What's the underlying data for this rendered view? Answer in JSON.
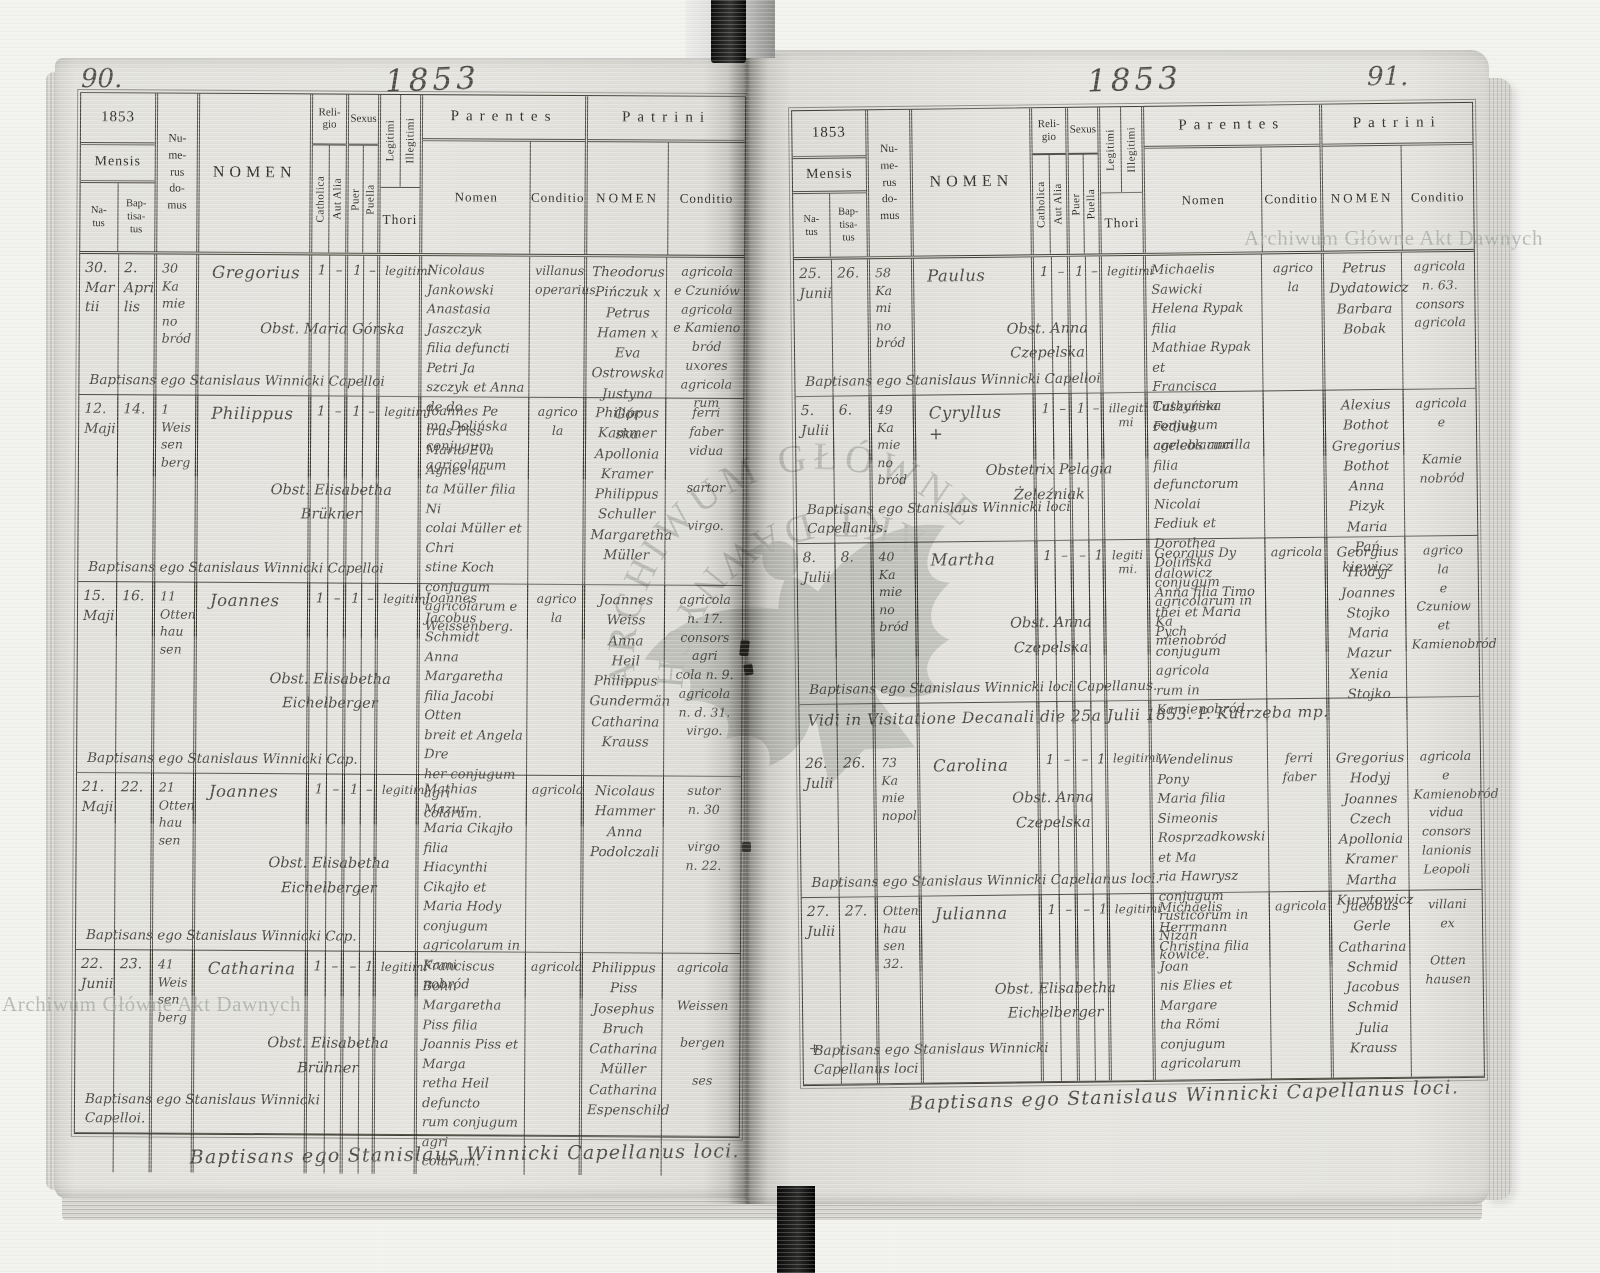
{
  "document": {
    "archive_stamp": "Archiwum Główne Akt Dawnych",
    "stamp_arc_top": "ARCHIWUM GŁÓWNE",
    "stamp_arc_bottom": "AKT DAWNYCH"
  },
  "columns": {
    "year": "1853",
    "mensis": "Mensis",
    "natus": "Na-\ntus",
    "baptisatus": "Bap-\ntisa-\ntus",
    "numerus_domus": "Nu-\nme-\nrus\ndo-\nmus",
    "nomen": "NOMEN",
    "religio": "Reli-\ngio",
    "catholica": "Catholica",
    "aut_alia": "Aut Alia",
    "sexus": "Sexus",
    "puer": "Puer",
    "puella": "Puella",
    "legitimi": "Legitimi",
    "illegitimi": "Illegitimi",
    "thori": "Thori",
    "parentes": "Parentes",
    "patrini": "Patrini",
    "sub_nomen": "Nomen",
    "sub_conditio": "Conditio",
    "patrini_nomen": "NOMEN",
    "patrini_conditio": "Conditio"
  },
  "left_page": {
    "page_number": "90.",
    "year_script": "1853",
    "footer_script": "Baptisans ego Stanislaus Winnicki Capellanus loci.",
    "rows": [
      {
        "natus": "30.\nMar\ntii",
        "baptisatus": "2.\nApri\nlis",
        "domus": "30\nKa\nmie\nno\nbród",
        "nomen": "Gregorius",
        "obstetrix": "Obst. Maria Górska",
        "baptisans": "Baptisans ego Stanislaus Winnicki Capelloi",
        "catholica": "1",
        "aut_alia": "–",
        "puer": "1",
        "puella": "–",
        "thori": "legitimi",
        "parentes_nomen": "Nicolaus\nJankowski\nAnastasia Jaszczyk\nfilia defuncti Petri Ja\nszczyk et Anna de do\nmo Dolińska conjugum\nagricolarum",
        "parentes_conditio": "villanus\noperarius",
        "patrini_nomen": "Theodorus\nPińczuk x\nPetrus\nHamen x\nEva Ostrowska\nJustyna Gór\nska",
        "patrini_conditio": "agricola\ne Czuniów\nagricola\ne Kamieno\nbród\nuxores\nagricola\nrum"
      },
      {
        "natus": "12.\nMaji",
        "baptisatus": "14.",
        "domus": "1\nWeis\nsen\nberg",
        "nomen": "Philippus",
        "obstetrix": "Obst. Elisabetha\nBrükner",
        "baptisans": "Baptisans ego Stanislaus Winnicki Capelloi",
        "catholica": "1",
        "aut_alia": "–",
        "puer": "1",
        "puella": "–",
        "thori": "legitimi",
        "parentes_nomen": "Joannes Pe\ntrus Piss\nMaria Eva Agnes na\nta Müller filia Ni\ncolai Müller et Chri\nstine Koch conjugum\nagricolarum e\nWeissenberg.",
        "parentes_conditio": "agrico\nla",
        "patrini_nomen": "Philippus\nKammer\nApollonia\nKramer\nPhilippus\nSchuller\nMargaretha\nMüller",
        "patrini_conditio": "ferri\nfaber\nvidua\n\nsartor\n\nvirgo."
      },
      {
        "natus": "15.\nMaji",
        "baptisatus": "16.",
        "domus": "11\nOtten\nhau\nsen",
        "nomen": "Joannes",
        "obstetrix": "Obst. Elisabetha\nEichelberger",
        "baptisans": "Baptisans ego Stanislaus Winnicki Cap.",
        "catholica": "1",
        "aut_alia": "–",
        "puer": "1",
        "puella": "–",
        "thori": "legitimi",
        "parentes_nomen": "Joannes\nJacobus\nSchmidt\nAnna Margaretha\nfilia Jacobi Otten\nbreit et Angela Dre\nher conjugum agri\ncolarum.",
        "parentes_conditio": "agrico\nla",
        "patrini_nomen": "Joannes\nWeiss\nAnna\nHeil\nPhilippus\nGundermän\nCatharina\nKrauss",
        "patrini_conditio": "agricola\nn. 17.\nconsors agri\ncola n. 9.\nagricola\nn. d. 31.\nvirgo."
      },
      {
        "natus": "21.\nMaji",
        "baptisatus": "22.",
        "domus": "21\nOtten\nhau\nsen",
        "nomen": "Joannes",
        "obstetrix": "Obst. Elisabetha\nEichelberger",
        "baptisans": "Baptisans ego Stanislaus Winnicki Cap.",
        "catholica": "1",
        "aut_alia": "–",
        "puer": "1",
        "puella": "–",
        "thori": "legitimi",
        "parentes_nomen": "Mathias\nMazur\nMaria Cikajło filia\nHiacynthi Cikajło et\nMaria Hody conjugum\nagricolarum in Kami\nnobród",
        "parentes_conditio": "agricola",
        "patrini_nomen": "Nicolaus\nHammer\nAnna\nPodolczali",
        "patrini_conditio": "sutor\nn. 30\n\nvirgo\nn. 22."
      },
      {
        "natus": "22.\nJunii",
        "baptisatus": "23.",
        "domus": "41\nWeis\nsen\nberg",
        "nomen": "Catharina",
        "obstetrix": "Obst. Elisabetha\nBrühner",
        "baptisans": "Baptisans ego Stanislaus Winnicki\nCapelloi.",
        "catholica": "1",
        "aut_alia": "–",
        "puer": "–",
        "puella": "1",
        "thori": "legitimi",
        "parentes_nomen": "Franciscus\nBohn\nMargaretha Piss filia\nJoannis Piss et Marga\nretha Heil defuncto\nrum conjugum agri\ncolarum.",
        "parentes_conditio": "agricola",
        "patrini_nomen": "Philippus\nPiss\nJosephus\nBruch\nCatharina\nMüller\nCatharina\nEspenschild",
        "patrini_conditio": "agricola\n\nWeissen\n\nbergen\n\nses"
      }
    ]
  },
  "right_page": {
    "page_number": "91.",
    "year_script": "1853",
    "footer_script": "Baptisans ego Stanislaus Winnicki Capellanus loci.",
    "rows": [
      {
        "natus": "25.\nJunii",
        "baptisatus": "26.",
        "domus": "58\nKa\nmi\nno\nbród",
        "nomen": "Paulus",
        "obstetrix": "Obst. Anna\nCzepelska",
        "baptisans": "Baptisans ego Stanislaus Winnicki Capelloi",
        "catholica": "1",
        "aut_alia": "–",
        "puer": "1",
        "puella": "–",
        "thori": "legitimi",
        "parentes_nomen": "Michaelis\nSawicki\nHelena Rypak filia\nMathiae Rypak et\nFrancisca Tuszyńska\nconjugum agricolarum",
        "parentes_conditio": "agrico\nla",
        "patrini_nomen": "Petrus\nDydatowicz\nBarbara\nBobak",
        "patrini_conditio": "agricola\nn. 63.\nconsors\nagricola"
      },
      {
        "natus": "5.\nJulii",
        "baptisatus": "6.",
        "domus": "49\nKa\nmie\nno\nbród",
        "nomen": "Cyryllus\n+",
        "obstetrix": "Obstetrix Pelagia\nŻeleźniak",
        "baptisans": "Baptisans ego Stanislaus Winnicki loci\nCapellanus.",
        "catholica": "1",
        "aut_alia": "–",
        "puer": "1",
        "puella": "–",
        "thori": "illegiti\nmi",
        "parentes_nomen": "Catharina Fediuk\ncoelebs ancilla filia\ndefunctorum Nicolai\nFediuk et Dorothea\nDolińska conjugum\nagricolarum in Ka\nmienobród",
        "parentes_conditio": "",
        "patrini_nomen": "Alexius\nBothot\nGregorius\nBothot\nAnna Pizyk\nMaria Pań\nkiewicz",
        "patrini_conditio": "agricola\ne\n\nKamie\nnobród"
      },
      {
        "natus": "8.\nJulii",
        "baptisatus": "8.",
        "domus": "40\nKa\nmie\nno\nbród",
        "nomen": "Martha",
        "obstetrix": "Obst. Anna\nCzepelska",
        "baptisans": "Baptisans ego Stanislaus Winnicki loci Capellanus.",
        "catholica": "1",
        "aut_alia": "–",
        "puer": "–",
        "puella": "1",
        "thori": "legiti\nmi.",
        "parentes_nomen": "Georgius Dy\ndalowicz\nAnna filia Timo\nthei et Maria Pych\nconjugum agricola\nrum in Kamienobród",
        "parentes_conditio": "agricola",
        "patrini_nomen": "Georgius\nHodyj\nJoannes\nStojko\nMaria\nMazur\nXenia\nStojko",
        "patrini_conditio": "agrico\nla\ne\nCzuniow\net\nKamienobród"
      },
      {
        "note": "Vidi in Visitatione Decanali die 25a Julii 1853. P. Kutrzeba mp.",
        "natus": "26.\nJulii",
        "baptisatus": "26.",
        "domus": "73\nKa\nmie\nnopol",
        "nomen": "Carolina",
        "obstetrix": "Obst. Anna\nCzepelska",
        "baptisans": "Baptisans ego Stanislaus Winnicki Capellanus loci.",
        "catholica": "1",
        "aut_alia": "–",
        "puer": "–",
        "puella": "1",
        "thori": "legitimi",
        "parentes_nomen": "Wendelinus\nPony\nMaria filia Simeonis\nRosprzadkowski et Ma\nria Hawrysz conjugum\nrusticorum in Nizan\nkowice.",
        "parentes_conditio": "ferri\nfaber",
        "patrini_nomen": "Gregorius\nHodyj\nJoannes\nCzech\nApollonia\nKramer\nMartha\nKurytowicz",
        "patrini_conditio": "agricola\ne\nKamienobród\nvidua\nconsors\nlanionis\nLeopoli"
      },
      {
        "natus": "27.\nJulii\n\n\n\n\n\n+",
        "baptisatus": "27.",
        "domus": "Otten\nhau\nsen\n32.",
        "nomen": "Julianna",
        "obstetrix": "Obst. Elisabetha\nEichelberger",
        "baptisans": "Baptisans ego Stanislaus Winnicki\nCapellanus loci",
        "catholica": "1",
        "aut_alia": "–",
        "puer": "–",
        "puella": "1",
        "thori": "legitimi",
        "parentes_nomen": "Michaelis\nHerrmann\nChristina filia Joan\nnis Elies et Margare\ntha Römi conjugum\nagricolarum",
        "parentes_conditio": "agricola",
        "patrini_nomen": "Jacobus\nGerle\nCatharina\nSchmid\nJacobus\nSchmid\nJulia\nKrauss",
        "patrini_conditio": "villani\nex\n\nOtten\nhausen"
      }
    ]
  }
}
